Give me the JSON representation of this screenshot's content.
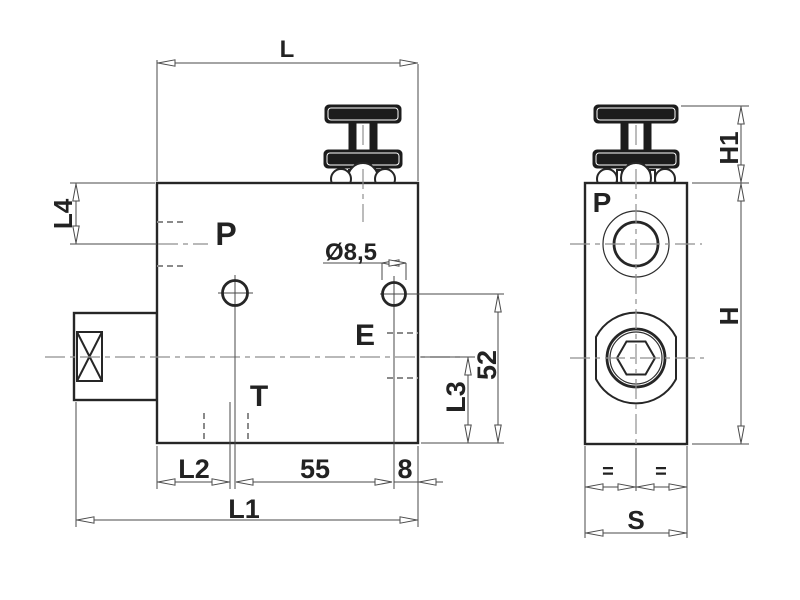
{
  "front_view": {
    "dim_top": "L",
    "dim_left_offset": "L4",
    "port_p": "P",
    "hole_diameter": "Ø8,5",
    "port_e": "E",
    "port_t": "T",
    "dim_l2": "L2",
    "dim_55": "55",
    "dim_8": "8",
    "dim_overall": "L1",
    "dim_52": "52",
    "dim_l3": "L3"
  },
  "side_view": {
    "port_p": "P",
    "dim_h1": "H1",
    "dim_h": "H",
    "eq_left": "=",
    "eq_right": "=",
    "dim_s": "S"
  },
  "colors": {
    "line": "#262626",
    "dimension_line": "#4a4a4a",
    "hidden_line": "#8a8a8a",
    "centerline": "#8f8f8f",
    "knob_fill": "#1c1c1c",
    "background": "#ffffff"
  }
}
